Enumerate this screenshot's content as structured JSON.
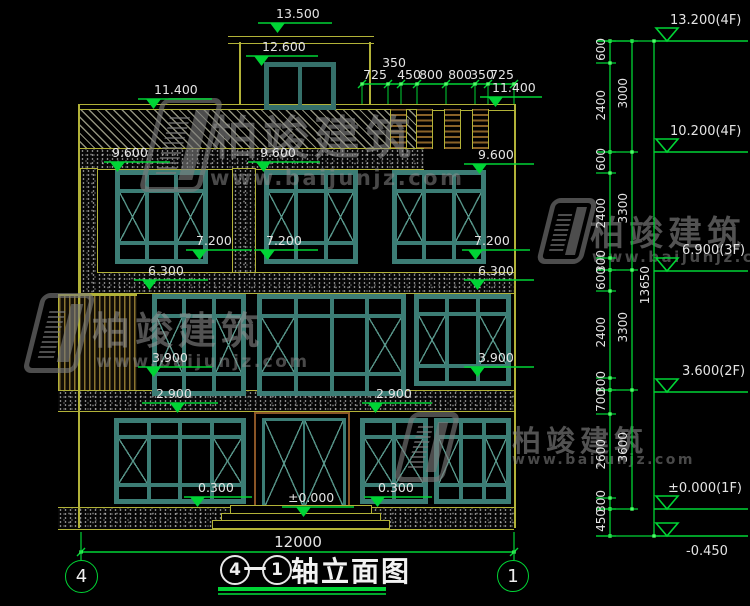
{
  "brand": {
    "name": "柏竣建筑",
    "url": "www.baijunjz.com"
  },
  "title": {
    "b1": "4",
    "dash": "—",
    "b2": "1",
    "text": "轴立面图"
  },
  "axis_bubbles": {
    "left": "4",
    "right": "1"
  },
  "dims": {
    "overall_width": "12000",
    "overall_height": "13650",
    "top_raised": "350",
    "top_row": [
      "725",
      "450",
      "800",
      "800",
      "350",
      "725"
    ],
    "right_inner": [
      "600",
      "2400",
      "600",
      "2400",
      "300",
      "600",
      "2400",
      "300",
      "700",
      "2600",
      "300",
      "450"
    ],
    "right_floor": [
      "3000",
      "3300",
      "3300",
      "3600"
    ]
  },
  "level_marks": [
    "13.500",
    "12.600",
    "11.400",
    "11.400",
    "9.600",
    "9.600",
    "9.600",
    "7.200",
    "7.200",
    "7.200",
    "6.300",
    "6.300",
    "3.900",
    "3.900",
    "2.900",
    "2.900",
    "0.300",
    "0.300",
    "±0.000"
  ],
  "right_levels": [
    "13.200(4F)",
    "10.200(4F)",
    "6.900(3F)",
    "3.600(2F)",
    "±0.000(1F)",
    "-0.450"
  ]
}
